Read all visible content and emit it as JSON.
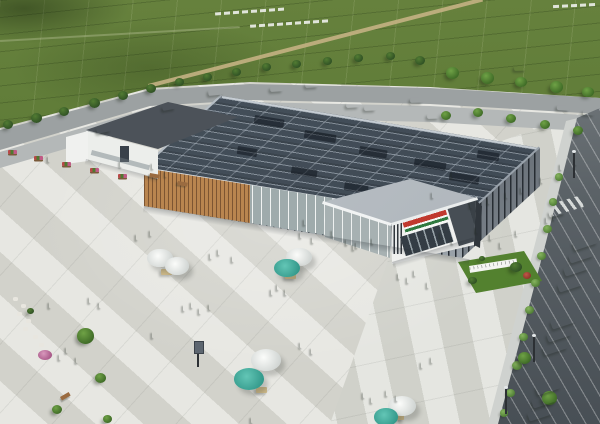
{
  "meta": {
    "description": "Aerial architectural rendering: traditional market hall with dark steel-and-glass canopy roof, white entrance pavilion with an illegible red-and-green sign, white gabled side wing, large striped pedestrian plaza with people and market umbrellas, landscaped garden strips, perimeter roads with trees, angled parking with cars, and green farm fields behind",
    "width": 600,
    "height": 424
  },
  "palette": {
    "field_green": "#5d7a36",
    "plaza_light": "#e7e7e2",
    "plaza_dark": "#d2d2cb",
    "canopy_steel": "#3f4954",
    "wood_slats": "#b9854f",
    "road_asphalt": "#565d63",
    "umbrella_teal": "#3aa393",
    "umbrella_white": "#f7f8f6",
    "sign_red": "#c0392e",
    "sign_green": "#2f7a3f"
  },
  "entrance_sign": {
    "legible": false,
    "line_colors": [
      "#c0392e",
      "#2f7a3f"
    ]
  },
  "scene": {
    "trees": [
      [
        8,
        124,
        10,
        0
      ],
      [
        36,
        118,
        11,
        0
      ],
      [
        64,
        111,
        10,
        0
      ],
      [
        94,
        103,
        11,
        0
      ],
      [
        123,
        95,
        10,
        0
      ],
      [
        151,
        88,
        10,
        0
      ],
      [
        179,
        82,
        9,
        0
      ],
      [
        207,
        77,
        9,
        0
      ],
      [
        236,
        72,
        9,
        0
      ],
      [
        266,
        67,
        9,
        0
      ],
      [
        296,
        64,
        9,
        0
      ],
      [
        327,
        61,
        9,
        0
      ],
      [
        358,
        58,
        9,
        0
      ],
      [
        390,
        56,
        9,
        0
      ],
      [
        420,
        60,
        10,
        0
      ],
      [
        452,
        73,
        13,
        1
      ],
      [
        487,
        78,
        13,
        1
      ],
      [
        521,
        82,
        12,
        1
      ],
      [
        556,
        87,
        13,
        1
      ],
      [
        588,
        92,
        12,
        1
      ],
      [
        446,
        115,
        10,
        1
      ],
      [
        478,
        112,
        10,
        1
      ],
      [
        511,
        118,
        10,
        1
      ],
      [
        545,
        124,
        10,
        1
      ],
      [
        578,
        130,
        10,
        1
      ],
      [
        559,
        177,
        8,
        2
      ],
      [
        553,
        202,
        8,
        2
      ],
      [
        547,
        229,
        9,
        2
      ],
      [
        541,
        256,
        9,
        2
      ],
      [
        535,
        283,
        9,
        2
      ],
      [
        529,
        310,
        9,
        2
      ],
      [
        523,
        337,
        9,
        2
      ],
      [
        517,
        365,
        10,
        2
      ],
      [
        510,
        393,
        9,
        2
      ],
      [
        504,
        413,
        8,
        2
      ],
      [
        524,
        358,
        13,
        1
      ],
      [
        549,
        398,
        15,
        1
      ],
      [
        85,
        336,
        17,
        1
      ],
      [
        100,
        378,
        11,
        1
      ],
      [
        57,
        409,
        10,
        1
      ],
      [
        107,
        419,
        9,
        1
      ],
      [
        30,
        311,
        7,
        0
      ]
    ],
    "cars": [
      [
        103,
        131,
        14,
        "#e9ebeb",
        -12
      ],
      [
        168,
        109,
        13,
        "#dde0e0",
        -10
      ],
      [
        215,
        93,
        15,
        "#eef0f0",
        -6
      ],
      [
        276,
        90,
        13,
        "#c8cbcd",
        -4
      ],
      [
        311,
        86,
        13,
        "#2f3438",
        -4
      ],
      [
        352,
        106,
        13,
        "#e8eaea",
        -3
      ],
      [
        370,
        108,
        12,
        "#caccce",
        -3
      ],
      [
        416,
        101,
        13,
        "#e5e7e7",
        -2
      ],
      [
        433,
        116,
        12,
        "#32373b",
        -2
      ],
      [
        563,
        108,
        13,
        "#2e3338",
        3
      ],
      [
        589,
        112,
        12,
        "#c5c8ca",
        3
      ],
      [
        520,
        68,
        12,
        "#e7e9e9",
        -2
      ],
      [
        556,
        214,
        16,
        "#eaecec",
        -15
      ]
    ],
    "parked_cars": [
      [
        584,
        246,
        "#23272b"
      ],
      [
        580,
        259,
        "#202428"
      ],
      [
        575,
        272,
        "#b5b9bb"
      ],
      [
        569,
        288,
        "#c7cacc"
      ],
      [
        562,
        325,
        "#2a2e33"
      ],
      [
        558,
        338,
        "#b5b9bb"
      ],
      [
        554,
        351,
        "#23272b"
      ],
      [
        547,
        391,
        "#2a2e33"
      ],
      [
        543,
        404,
        "#3a3f44"
      ],
      [
        539,
        417,
        "#b5b9bb"
      ]
    ],
    "umbrellas": [
      [
        160,
        258,
        26,
        0
      ],
      [
        177,
        266,
        24,
        0
      ],
      [
        299,
        257,
        26,
        0
      ],
      [
        287,
        268,
        26,
        1
      ],
      [
        266,
        360,
        30,
        0
      ],
      [
        249,
        379,
        30,
        1
      ],
      [
        402,
        406,
        28,
        0
      ],
      [
        386,
        417,
        24,
        1
      ]
    ],
    "stalls": [
      [
        166,
        272
      ],
      [
        290,
        276
      ],
      [
        261,
        390
      ],
      [
        398,
        417
      ]
    ],
    "people": [
      [
        210,
        252,
        "#3a4454"
      ],
      [
        218,
        248,
        "#8a6a4a"
      ],
      [
        232,
        255,
        "#2e3238"
      ],
      [
        300,
        231,
        "#5a6a8a"
      ],
      [
        312,
        236,
        "#c8a070"
      ],
      [
        332,
        229,
        "#2e3238"
      ],
      [
        356,
        241,
        "#b04038"
      ],
      [
        372,
        237,
        "#3a4454"
      ],
      [
        304,
        218,
        "#e8e8e6"
      ],
      [
        398,
        272,
        "#2e3238"
      ],
      [
        407,
        276,
        "#c8a070"
      ],
      [
        414,
        269,
        "#3a4454"
      ],
      [
        427,
        281,
        "#2e3238"
      ],
      [
        440,
        231,
        "#3a4454"
      ],
      [
        452,
        237,
        "#e8e8e6"
      ],
      [
        476,
        226,
        "#2e3238"
      ],
      [
        490,
        233,
        "#c8a070"
      ],
      [
        500,
        241,
        "#3a4454"
      ],
      [
        516,
        229,
        "#2e3238"
      ],
      [
        470,
        201,
        "#5a6a8a"
      ],
      [
        488,
        197,
        "#2e3238"
      ],
      [
        506,
        191,
        "#e8e8e6"
      ],
      [
        521,
        186,
        "#3a4454"
      ],
      [
        541,
        176,
        "#2e3238"
      ],
      [
        452,
        171,
        "#2e3238"
      ],
      [
        432,
        191,
        "#8a6a4a"
      ],
      [
        560,
        163,
        "#3a4454"
      ],
      [
        575,
        158,
        "#3a4454"
      ],
      [
        136,
        233,
        "#3a4454"
      ],
      [
        150,
        229,
        "#b04038"
      ],
      [
        183,
        304,
        "#2e3238"
      ],
      [
        191,
        301,
        "#c8a070"
      ],
      [
        199,
        307,
        "#3a4454"
      ],
      [
        209,
        303,
        "#2e3238"
      ],
      [
        271,
        288,
        "#2e3238"
      ],
      [
        277,
        283,
        "#e8e8e6"
      ],
      [
        285,
        288,
        "#3a4454"
      ],
      [
        346,
        238,
        "#2e3238"
      ],
      [
        353,
        243,
        "#c8a070"
      ],
      [
        300,
        341,
        "#3a4454"
      ],
      [
        311,
        347,
        "#2e3238"
      ],
      [
        363,
        391,
        "#2e3238"
      ],
      [
        371,
        396,
        "#c8a070"
      ],
      [
        386,
        389,
        "#3a4454"
      ],
      [
        396,
        394,
        "#2e3238"
      ],
      [
        421,
        361,
        "#5a6a8a"
      ],
      [
        431,
        356,
        "#3a4454"
      ],
      [
        251,
        416,
        "#2e3238"
      ],
      [
        152,
        331,
        "#2e3238"
      ],
      [
        76,
        356,
        "#c8a070"
      ],
      [
        59,
        353,
        "#3a4454"
      ],
      [
        66,
        346,
        "#2e3238"
      ],
      [
        49,
        301,
        "#b04038"
      ],
      [
        89,
        296,
        "#3a4454"
      ],
      [
        99,
        301,
        "#2e3238"
      ],
      [
        546,
        216,
        "#2e3238"
      ],
      [
        553,
        213,
        "#8a6a4a"
      ],
      [
        48,
        155,
        "#2e3238"
      ],
      [
        120,
        160,
        "#b04038"
      ],
      [
        152,
        162,
        "#3a4454"
      ],
      [
        165,
        170,
        "#2e3238"
      ]
    ],
    "stones": [
      [
        13,
        297
      ],
      [
        21,
        304
      ],
      [
        17,
        312
      ],
      [
        26,
        319
      ],
      [
        23,
        327
      ],
      [
        33,
        335
      ],
      [
        39,
        343
      ],
      [
        47,
        351
      ]
    ],
    "planters": [
      [
        8,
        150
      ],
      [
        34,
        156
      ],
      [
        62,
        162
      ],
      [
        90,
        168
      ],
      [
        118,
        174
      ]
    ],
    "benches": [
      [
        150,
        173,
        10
      ],
      [
        178,
        181,
        10
      ],
      [
        60,
        397,
        -30
      ]
    ],
    "lamps": [
      [
        505,
        388
      ],
      [
        533,
        336
      ],
      [
        573,
        152
      ]
    ],
    "signposts": [
      [
        197,
        341
      ]
    ],
    "roof_vents": [
      [
        255,
        115,
        30
      ],
      [
        305,
        130,
        32
      ],
      [
        360,
        146,
        28
      ],
      [
        415,
        158,
        32
      ],
      [
        292,
        166,
        26
      ],
      [
        450,
        172,
        30
      ],
      [
        345,
        182,
        24
      ],
      [
        478,
        150,
        22
      ],
      [
        238,
        146,
        20
      ]
    ],
    "island_shrubs": [
      [
        516,
        268,
        12
      ],
      [
        472,
        281,
        9
      ],
      [
        482,
        259,
        6
      ],
      [
        527,
        276,
        8
      ]
    ]
  }
}
